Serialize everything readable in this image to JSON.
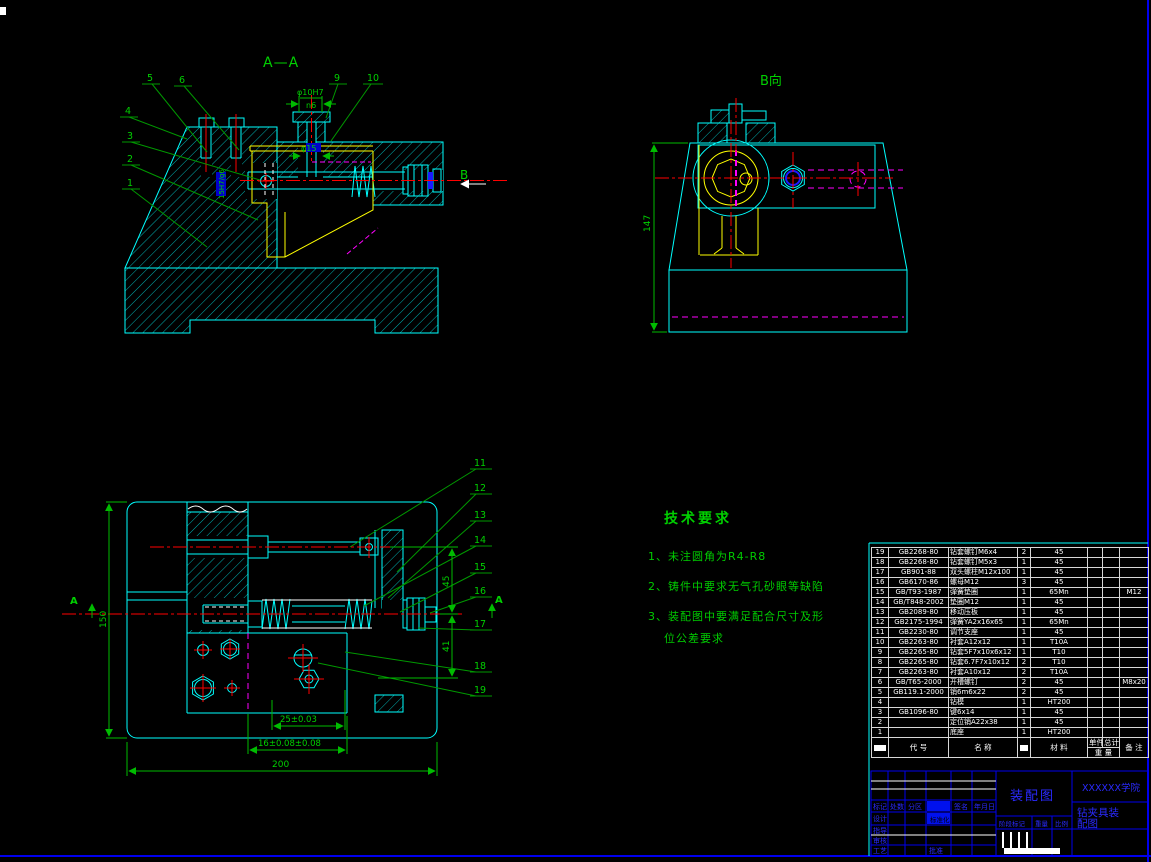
{
  "colors": {
    "cyan": "#00ffff",
    "yellow": "#ffff00",
    "red": "#ff0000",
    "green_text": "#00d000",
    "leader_green": "#009900",
    "magenta": "#ff00ff",
    "blue": "#1a1aff",
    "white": "#ffffff"
  },
  "views": {
    "aa": {
      "title": "A—A",
      "b_arrow": "B",
      "labels": [
        "1",
        "2",
        "3",
        "4",
        "5",
        "6",
        "9",
        "10"
      ],
      "dims": {
        "top_dia": "φ10H7",
        "top_fit": "n6",
        "bore": "φ15",
        "side": "15H7/g6"
      }
    },
    "b": {
      "title": "B向",
      "height": "147"
    },
    "plan": {
      "labels": [
        "11",
        "12",
        "13",
        "14",
        "15",
        "16",
        "17",
        "18",
        "19"
      ],
      "section_mark": "A",
      "dims": {
        "width": "200",
        "height": "150",
        "d25": "25±0.03",
        "d16": "16±0.08±0.08",
        "d45": "45",
        "d41": "41"
      }
    }
  },
  "tech_req": {
    "title": "技术要求",
    "items": [
      "1、未注圆角为R4-R8",
      "2、铸件中要求无气孔砂眼等缺陷",
      "3、装配图中要满足配合尺寸及形",
      "位公差要求"
    ]
  },
  "parts_table": {
    "rows": [
      {
        "no": "19",
        "code": "GB2268-80",
        "name": "钻套螺钉M6x4",
        "qty": "2",
        "mat": "45",
        "unit": "",
        "total": "",
        "remark": ""
      },
      {
        "no": "18",
        "code": "GB2268-80",
        "name": "钻套螺钉M5x3",
        "qty": "1",
        "mat": "45",
        "unit": "",
        "total": "",
        "remark": ""
      },
      {
        "no": "17",
        "code": "GB901-88",
        "name": "双头螺柱M12x100",
        "qty": "1",
        "mat": "45",
        "unit": "",
        "total": "",
        "remark": ""
      },
      {
        "no": "16",
        "code": "GB6170-86",
        "name": "螺母M12",
        "qty": "3",
        "mat": "45",
        "unit": "",
        "total": "",
        "remark": ""
      },
      {
        "no": "15",
        "code": "GB/T93-1987",
        "name": "弹簧垫圈",
        "qty": "1",
        "mat": "65Mn",
        "unit": "",
        "total": "",
        "remark": "M12"
      },
      {
        "no": "14",
        "code": "GB/T848-2002",
        "name": "垫圈M12",
        "qty": "1",
        "mat": "45",
        "unit": "",
        "total": "",
        "remark": ""
      },
      {
        "no": "13",
        "code": "GB2089-80",
        "name": "移动压板",
        "qty": "1",
        "mat": "45",
        "unit": "",
        "total": "",
        "remark": ""
      },
      {
        "no": "12",
        "code": "GB2175-1994",
        "name": "弹簧YA2x16x65",
        "qty": "1",
        "mat": "65Mn",
        "unit": "",
        "total": "",
        "remark": ""
      },
      {
        "no": "11",
        "code": "GB2230-80",
        "name": "调节支座",
        "qty": "1",
        "mat": "45",
        "unit": "",
        "total": "",
        "remark": ""
      },
      {
        "no": "10",
        "code": "GB2263-80",
        "name": "衬套A12x12",
        "qty": "1",
        "mat": "T10A",
        "unit": "",
        "total": "",
        "remark": ""
      },
      {
        "no": "9",
        "code": "GB2265-80",
        "name": "钻套5F7x10x6x12",
        "qty": "1",
        "mat": "T10",
        "unit": "",
        "total": "",
        "remark": ""
      },
      {
        "no": "8",
        "code": "GB2265-80",
        "name": "钻套6.7F7x10x12",
        "qty": "2",
        "mat": "T10",
        "unit": "",
        "total": "",
        "remark": ""
      },
      {
        "no": "7",
        "code": "GB2263-80",
        "name": "衬套A10x12",
        "qty": "2",
        "mat": "T10A",
        "unit": "",
        "total": "",
        "remark": ""
      },
      {
        "no": "6",
        "code": "GB/T65-2000",
        "name": "开槽螺钉",
        "qty": "2",
        "mat": "45",
        "unit": "",
        "total": "",
        "remark": "M8x20"
      },
      {
        "no": "5",
        "code": "GB119.1-2000",
        "name": "销6m6x22",
        "qty": "2",
        "mat": "45",
        "unit": "",
        "total": "",
        "remark": ""
      },
      {
        "no": "4",
        "code": "",
        "name": "钻模",
        "qty": "1",
        "mat": "HT200",
        "unit": "",
        "total": "",
        "remark": ""
      },
      {
        "no": "3",
        "code": "GB1096-80",
        "name": "键6x14",
        "qty": "1",
        "mat": "45",
        "unit": "",
        "total": "",
        "remark": ""
      },
      {
        "no": "2",
        "code": "",
        "name": "定位销A22x38",
        "qty": "1",
        "mat": "45",
        "unit": "",
        "total": "",
        "remark": ""
      },
      {
        "no": "1",
        "code": "",
        "name": "底座",
        "qty": "1",
        "mat": "HT200",
        "unit": "",
        "total": "",
        "remark": ""
      }
    ],
    "footer": {
      "code": "代 号",
      "name": "名 称",
      "material": "材 料",
      "unit": "单件",
      "total": "总计",
      "weight": "重 量",
      "remark": "备 注"
    }
  },
  "title_block": {
    "marks": {
      "mark": "标记",
      "count": "处数",
      "zone": "分区",
      "sign": "签名",
      "date": "年月日"
    },
    "roles": {
      "design": "设计",
      "guide": "指导",
      "check": "审核",
      "process": "工艺",
      "standard": "标准化",
      "approve": "批准"
    },
    "drawing_title": "装配图",
    "stage": "阶段标记",
    "weight": "重量",
    "scale": "比例",
    "org": "XXXXXX学院",
    "doc_line1": "钻夹具装",
    "doc_line2": "配图"
  }
}
